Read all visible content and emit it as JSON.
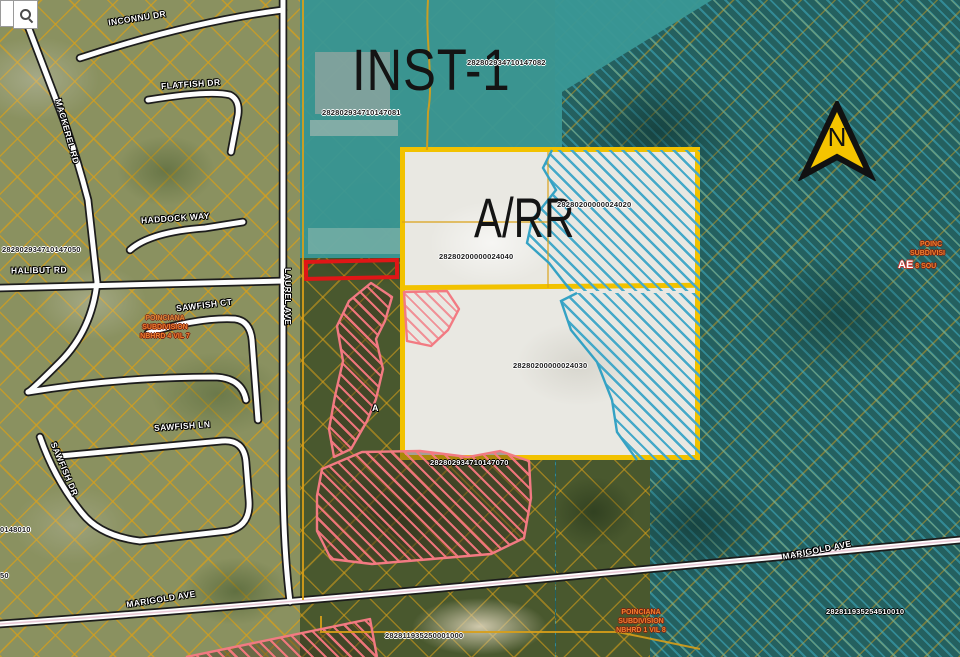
{
  "search": {
    "value": "",
    "icon": "magnifier"
  },
  "north": {
    "label": "N"
  },
  "zones": {
    "inst1": "INST-1",
    "arr": "A/RR",
    "a": "A",
    "ae": "AE"
  },
  "parcel_ids": [
    {
      "text": "282802934710147081"
    },
    {
      "text": "282802934710147082"
    },
    {
      "text": "28280200000024020"
    },
    {
      "text": "28280200000024040"
    },
    {
      "text": "28280200000024030"
    },
    {
      "text": "282802934710147070"
    },
    {
      "text": "282802934710147050"
    },
    {
      "text": "282811935250001000"
    },
    {
      "text": "282811935254510010"
    },
    {
      "text": "0148010"
    },
    {
      "text": "50"
    }
  ],
  "streets": [
    {
      "name": "INCONNU DR"
    },
    {
      "name": "FLATFISH DR"
    },
    {
      "name": "MACKEREL RD"
    },
    {
      "name": "HADDOCK WAY"
    },
    {
      "name": "HALIBUT RD"
    },
    {
      "name": "SAWFISH CT"
    },
    {
      "name": "SAWFISH LN"
    },
    {
      "name": "SAWFISH DR"
    },
    {
      "name": "LAUREL AVE"
    },
    {
      "name": "MARIGOLD AVE"
    },
    {
      "name": "MARIGOLD AVE"
    }
  ],
  "subdivisions": {
    "left": {
      "line1": "POINCIANA",
      "line2": "SUBDIVISION",
      "line3": "NBHRD 4 VIL 7"
    },
    "bottom": {
      "line1": "POINCIANA",
      "line2": "SUBDIVISION",
      "line3": "NBHRD 1 VIL 8"
    },
    "right_edge": {
      "line1": "POINC",
      "line2": "SUBDIVISI",
      "line3": "8 SOU"
    }
  },
  "colors": {
    "inst1_teal": "#399795",
    "conservation_teal": "#24605F",
    "parcel_outline_yellow": "#F2C200",
    "flood_hatch_blue": "#45A9C9",
    "zoning_hatch_red": "#F4767E",
    "selection_red": "#E01616",
    "parcel_line_orange": "#D89F18",
    "north_arrow_yellow": "#F5C400",
    "road_white": "#FDFDFD"
  }
}
